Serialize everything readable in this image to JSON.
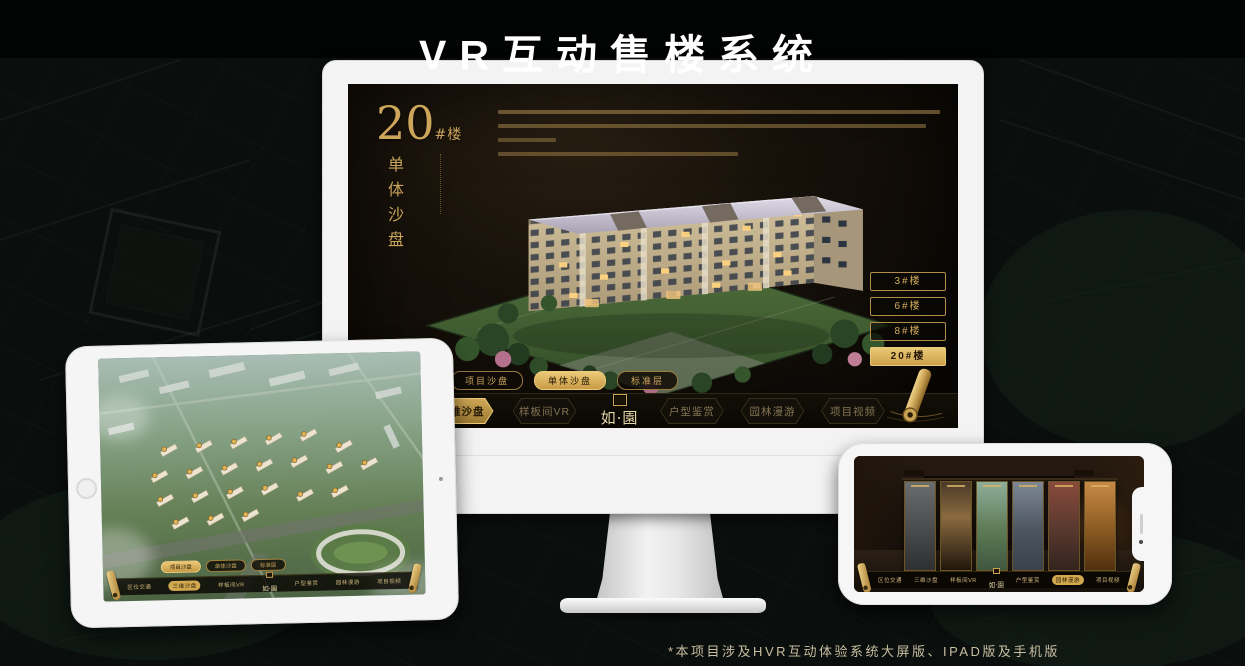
{
  "title": "VR互动售楼系统",
  "footnote": "*本项目涉及HVR互动体验系统大屏版、IPAD版及手机版",
  "colors": {
    "accent_gold": "#caa253",
    "gold_bright": "#ecca79",
    "screen_bg": "#15100a",
    "background": "#0a0e0c",
    "device_white": "#f5f5f5"
  },
  "icons": {
    "scroll": "gold-scroll-icon",
    "hexagon_badge": "hexagon-frame-icon",
    "seal": "logo-seal-icon",
    "home_button": "ipad-home-button",
    "camera": "front-camera-icon",
    "notch": "phone-notch"
  },
  "app": {
    "logo": "如·園",
    "nav_items": [
      "区位交通",
      "三维沙盘",
      "样板间VR",
      "户型鉴赏",
      "园林漫游",
      "项目视频"
    ],
    "sub_tabs": [
      "项目沙盘",
      "单体沙盘",
      "标准层"
    ]
  },
  "monitor_screen": {
    "building_no": "20",
    "building_no_suffix": "#楼",
    "subtitle_vertical": "单体沙盘",
    "floor_buttons": [
      "3#楼",
      "6#楼",
      "8#楼",
      "20#楼"
    ]
  }
}
